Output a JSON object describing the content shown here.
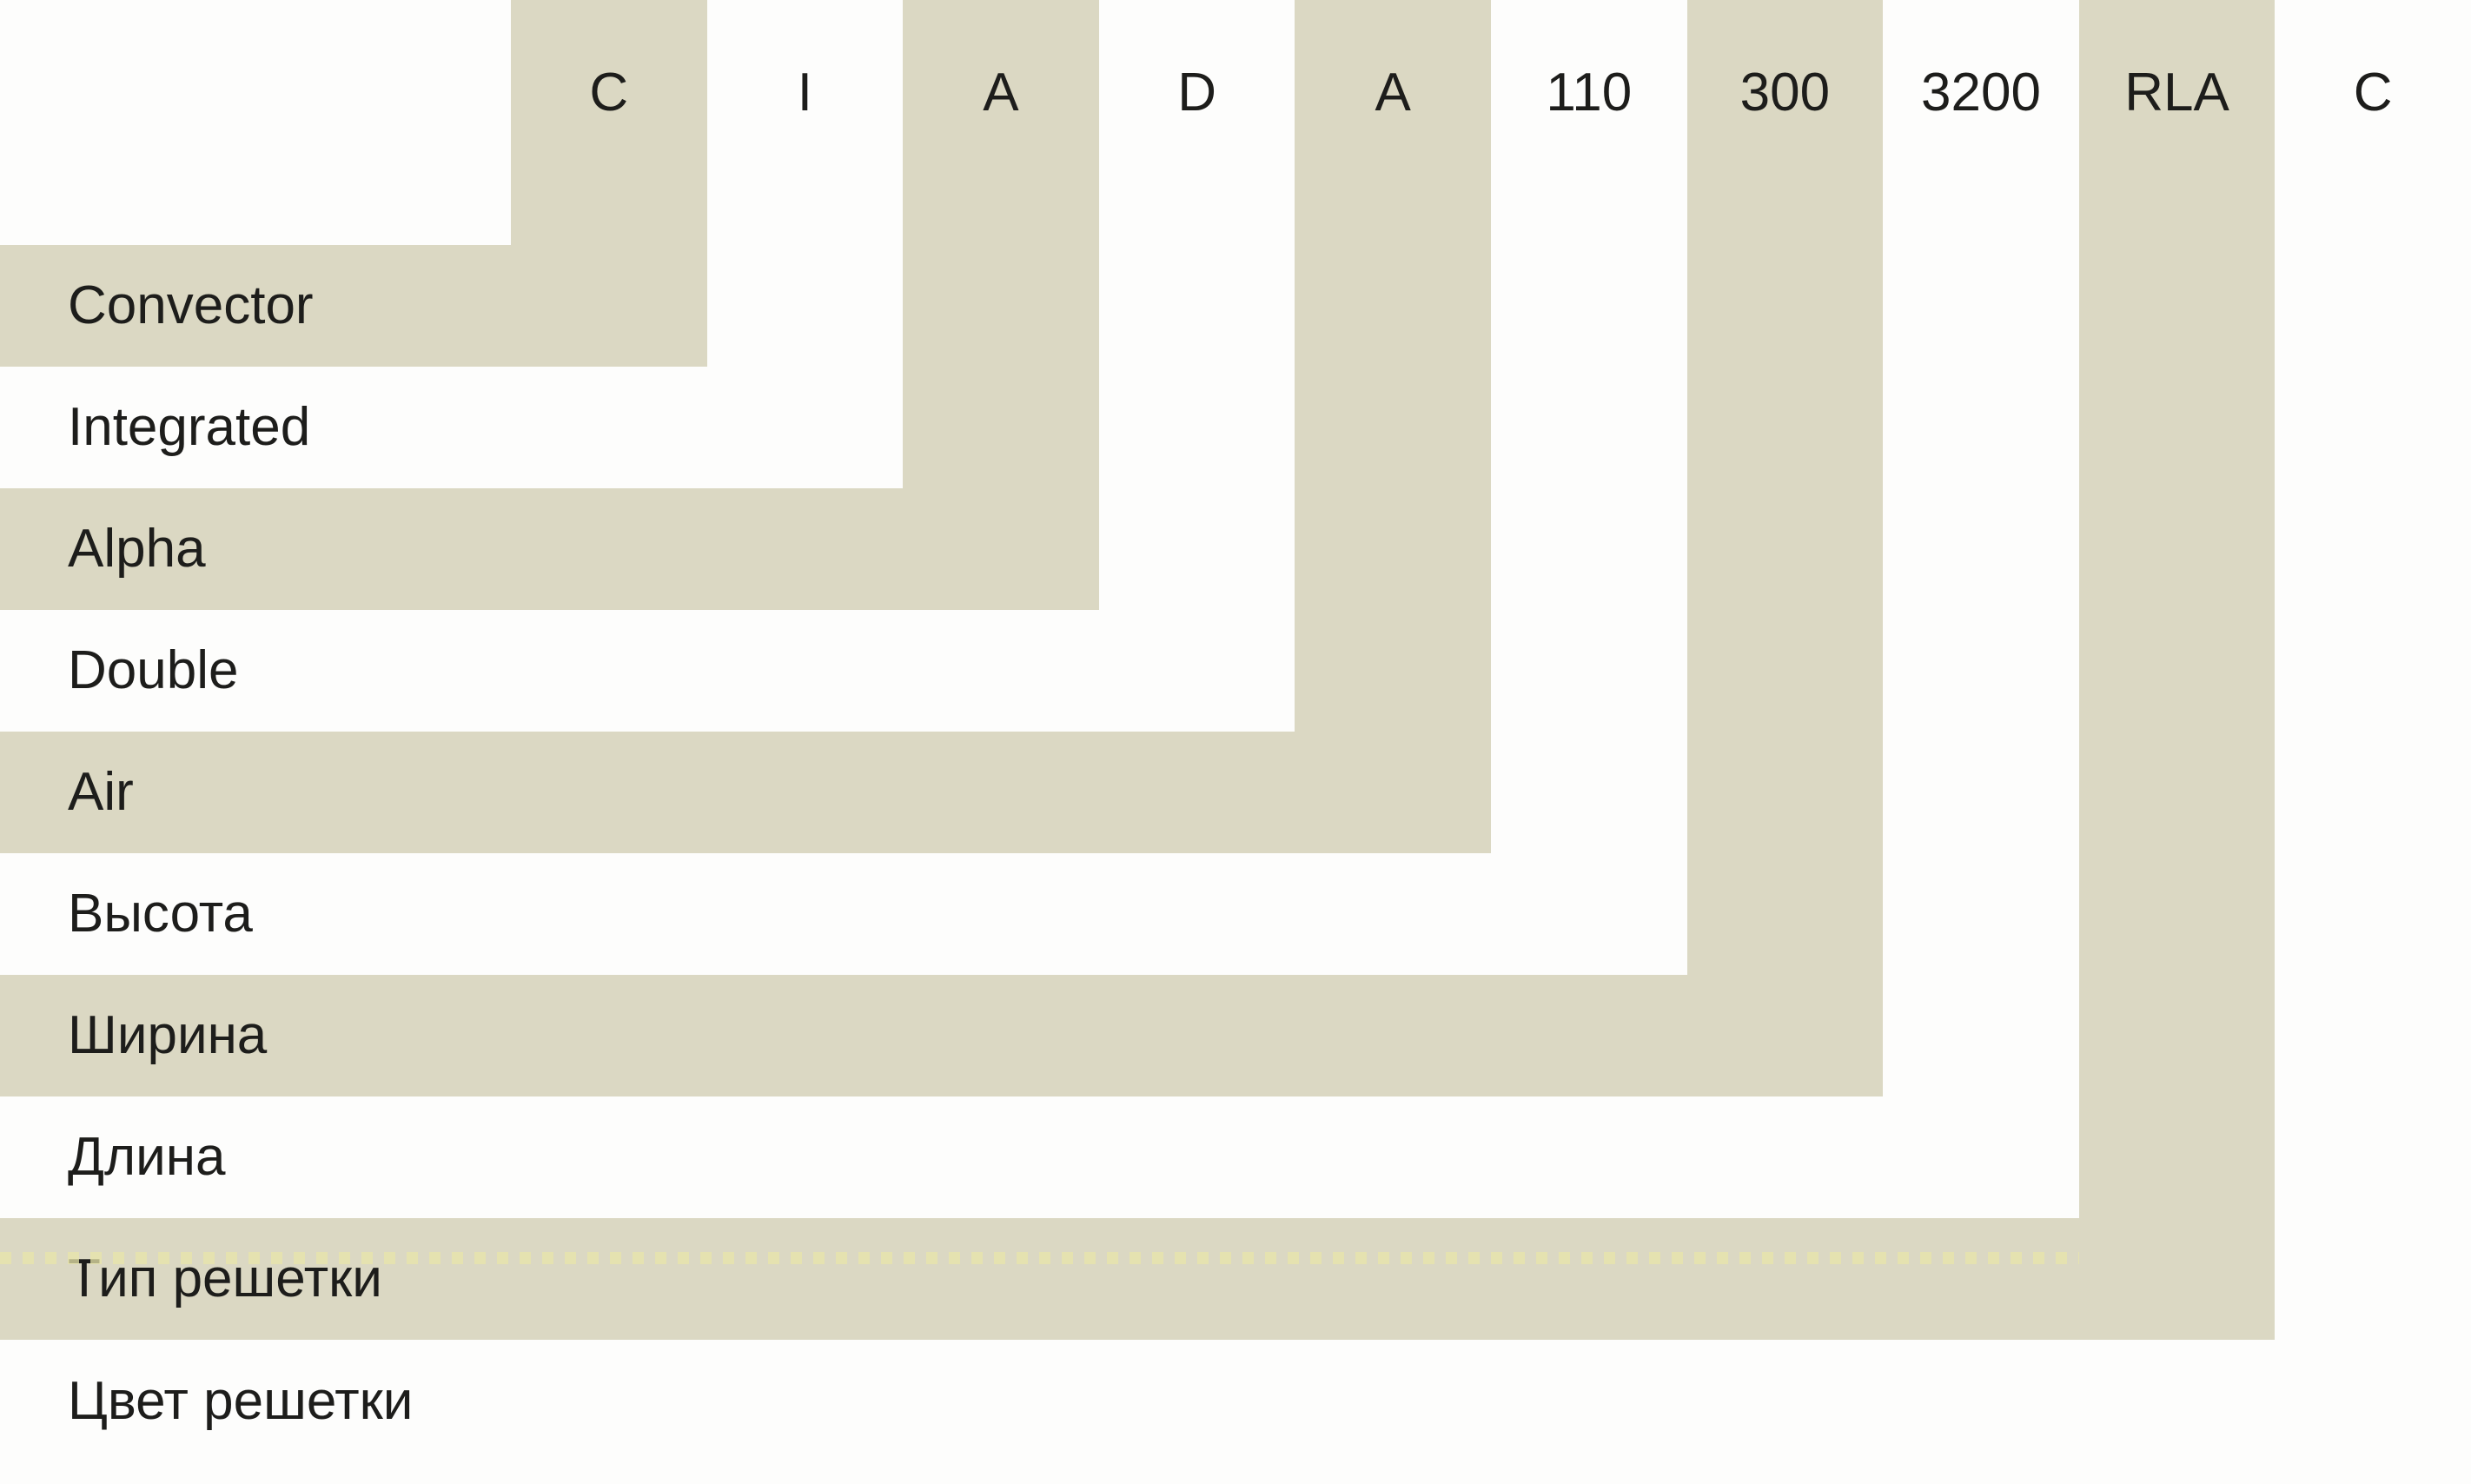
{
  "diagram": {
    "title": "Convector model code nomenclature",
    "items": [
      {
        "code": "C",
        "label": "Convector",
        "shade": "beige"
      },
      {
        "code": "I",
        "label": "Integrated",
        "shade": "white"
      },
      {
        "code": "A",
        "label": "Alpha",
        "shade": "beige"
      },
      {
        "code": "D",
        "label": "Double",
        "shade": "white"
      },
      {
        "code": "A",
        "label": "Air",
        "shade": "beige"
      },
      {
        "code": "110",
        "label": "Высота",
        "shade": "white"
      },
      {
        "code": "300",
        "label": "Ширина",
        "shade": "beige"
      },
      {
        "code": "3200",
        "label": "Длина",
        "shade": "white"
      },
      {
        "code": "RLA",
        "label": "Тип решетки",
        "shade": "beige"
      },
      {
        "code": "C",
        "label": "Цвет решетки",
        "shade": "white"
      }
    ],
    "colors": {
      "band_beige": "#dbd8c3",
      "background": "#fdfdfc",
      "text": "#1d1d1b",
      "dash_accent": "#e8e5aa"
    }
  }
}
